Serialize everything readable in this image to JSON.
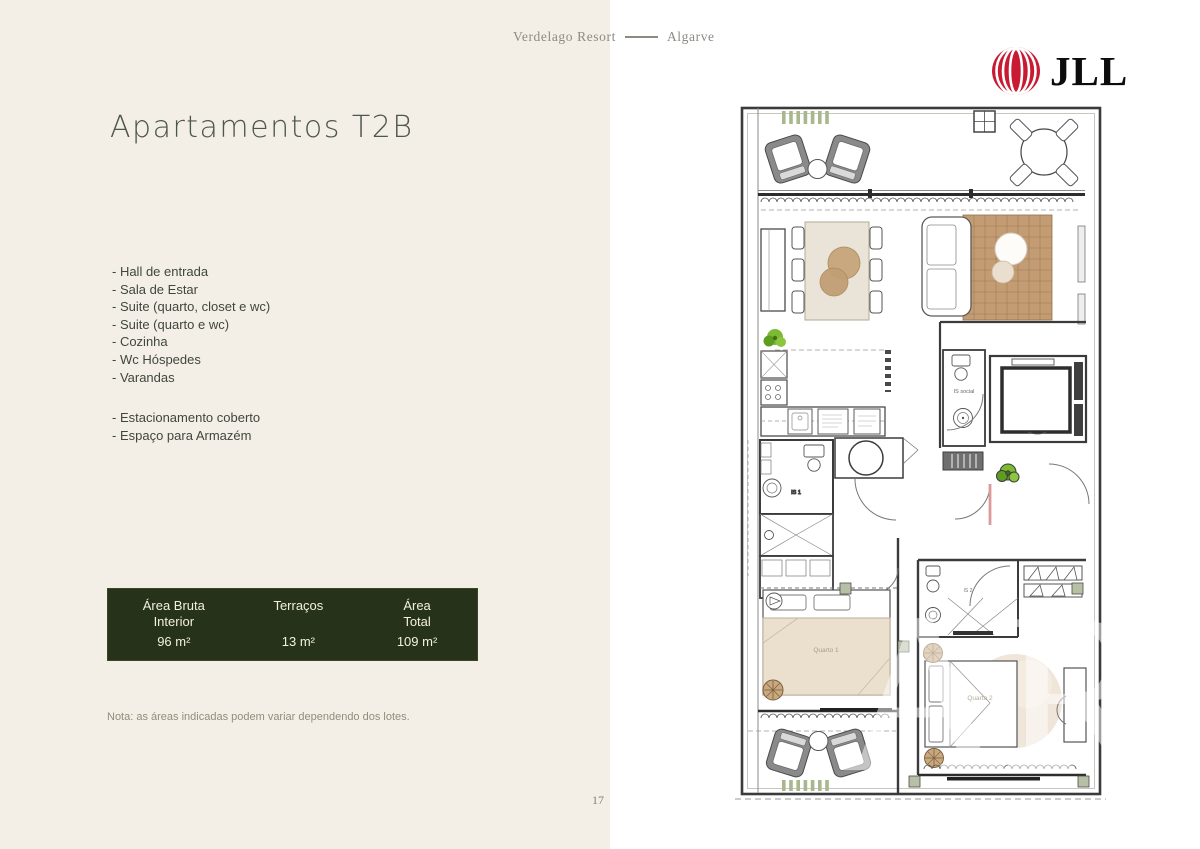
{
  "header": {
    "resort": "Verdelago Resort",
    "region": "Algarve"
  },
  "logo": {
    "brand": "JLL"
  },
  "left": {
    "title": "Apartamentos T2B",
    "features": [
      "- Hall de entrada",
      "- Sala de Estar",
      "- Suite (quarto, closet e wc)",
      "- Suite (quarto e wc)",
      "- Cozinha",
      "- Wc Hóspedes",
      "- Varandas"
    ],
    "extras": [
      "- Estacionamento coberto",
      "- Espaço para Armazém"
    ],
    "areas": {
      "col1": {
        "label": "Área Bruta Interior",
        "value": "96 m²"
      },
      "col2": {
        "label": "Terraços",
        "value": "13 m²"
      },
      "col3": {
        "label": "Área Total",
        "value": "109 m²"
      }
    },
    "note": "Nota: as áreas indicadas podem variar dependendo dos lotes.",
    "page_number": "17"
  },
  "plan": {
    "labels": {
      "is_social": "IS social",
      "is_1": "IS 1",
      "is_2": "IS 2",
      "quarto_1": "Quarto 1",
      "quarto_2": "Quarto 2"
    },
    "watermark": "AR"
  },
  "colors": {
    "cream_panel": "#f4efe6",
    "accent_green": "#26331a",
    "jll_red": "#c81a32",
    "rug_tan": "#c49c73"
  }
}
